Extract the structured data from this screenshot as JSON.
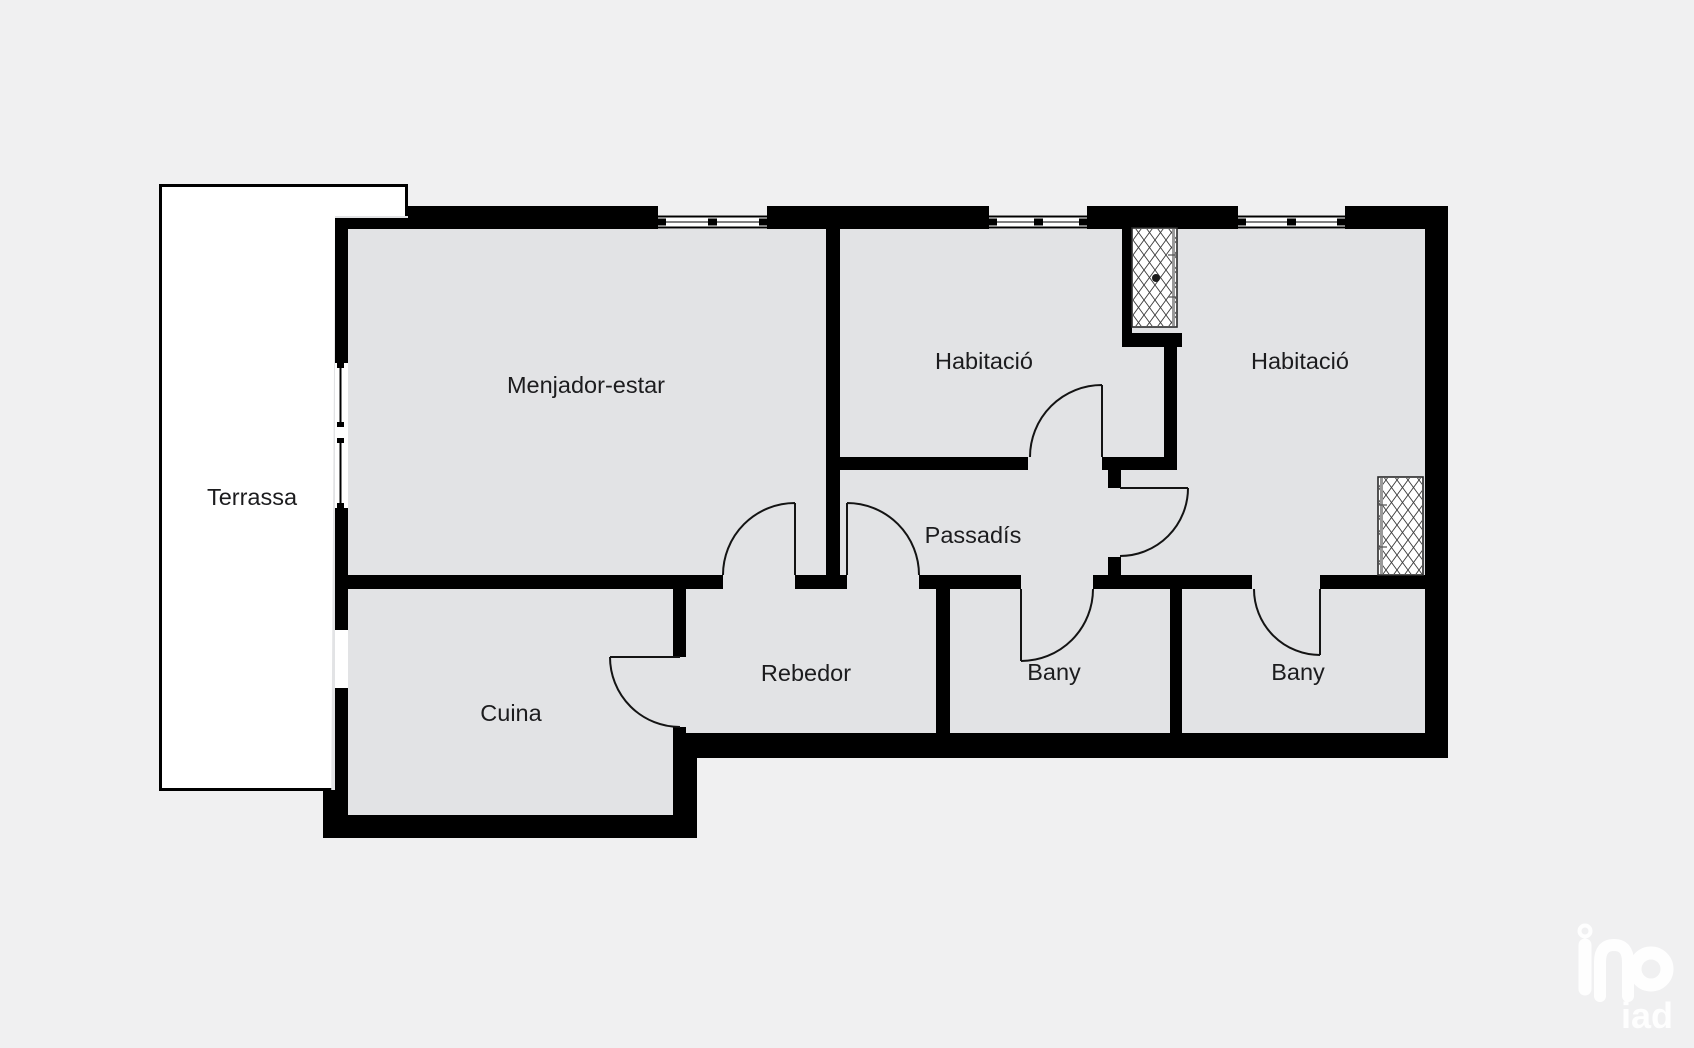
{
  "page": {
    "background": "#f0f0f1",
    "type_of_drawing": "floor-plan"
  },
  "plan": {
    "colors": {
      "background": "#f0f0f1",
      "floor": "#e2e3e5",
      "wall": "#000000",
      "label": "#1c1c1e",
      "terrace": "#ffffff"
    },
    "rooms": [
      {
        "id": "terrassa",
        "label": "Terrassa",
        "x": 252,
        "y": 505
      },
      {
        "id": "menjador-estar",
        "label": "Menjador-estar",
        "x": 586,
        "y": 393
      },
      {
        "id": "habitacio-1",
        "label": "Habitació",
        "x": 984,
        "y": 369
      },
      {
        "id": "habitacio-2",
        "label": "Habitació",
        "x": 1300,
        "y": 369
      },
      {
        "id": "passadis",
        "label": "Passadís",
        "x": 973,
        "y": 543
      },
      {
        "id": "rebedor",
        "label": "Rebedor",
        "x": 806,
        "y": 681
      },
      {
        "id": "cuina",
        "label": "Cuina",
        "x": 511,
        "y": 721
      },
      {
        "id": "bany-1",
        "label": "Bany",
        "x": 1054,
        "y": 680
      },
      {
        "id": "bany-2",
        "label": "Bany",
        "x": 1298,
        "y": 680
      }
    ],
    "features": {
      "windows_top": 3,
      "windows_terrace_side": 2,
      "wardrobes": 2,
      "doors": 7
    },
    "watermark": {
      "text": "iad"
    }
  }
}
